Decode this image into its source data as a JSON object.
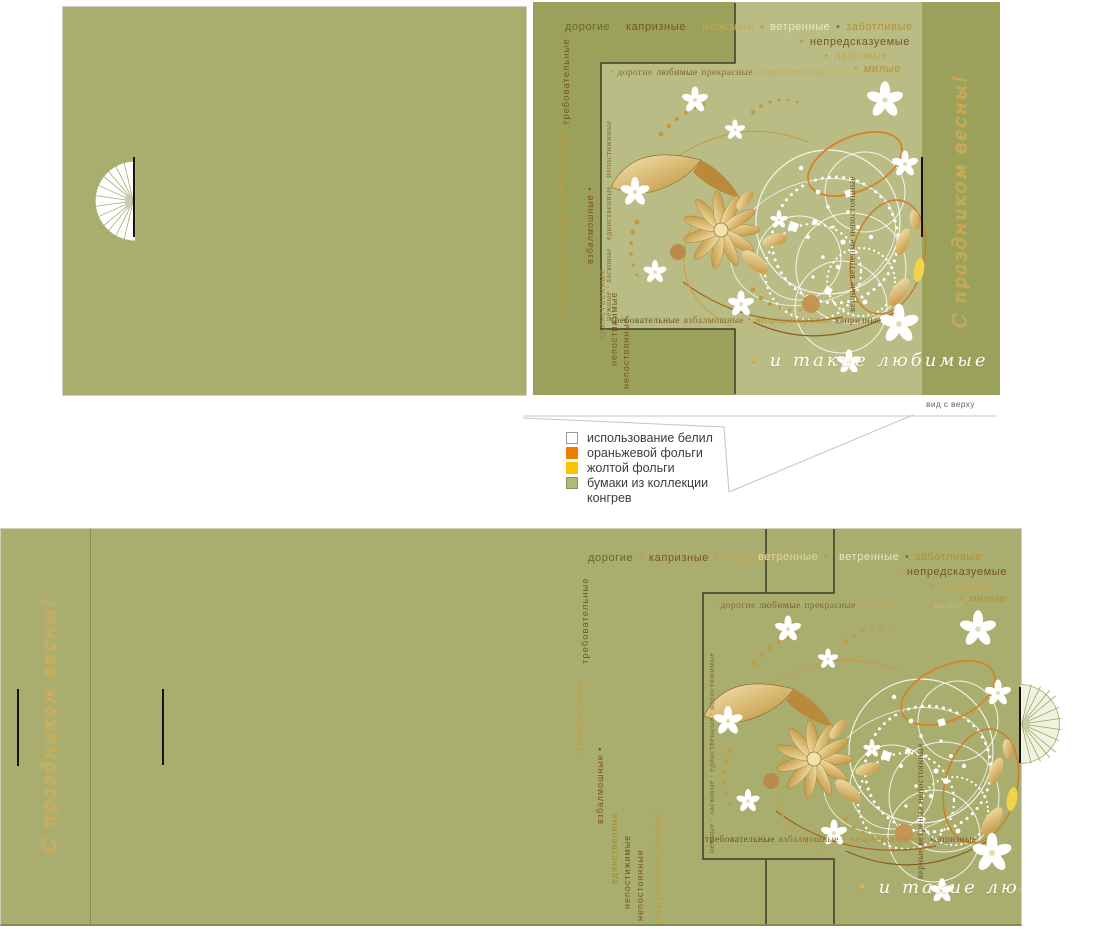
{
  "palette": {
    "olive": "#a9ae6e",
    "olive_dark": "#9ba15b",
    "panel_light": "#b9bd85",
    "gold": "#c59a3e",
    "script_gold": "#d2a03e",
    "outline": "#3c3c28",
    "orange_foil": "#ef7d00",
    "yellow_foil": "#fdc300"
  },
  "words": {
    "row1_top": [
      {
        "t": "дорогие",
        "c": "#6f6030"
      },
      {
        "t": "•",
        "c": "#c59a3e"
      },
      {
        "t": "капризные",
        "c": "#7b5322"
      },
      {
        "t": "•",
        "c": "#c59a3e"
      },
      {
        "t": "нежные",
        "c": "#c9a64c",
        "i": 1
      },
      {
        "t": "•",
        "c": "#c59a3e"
      },
      {
        "t": "ветренные",
        "c": "#ece6c6"
      },
      {
        "t": "•",
        "c": "#8a6a25"
      },
      {
        "t": "заботливые",
        "c": "#b68f35"
      }
    ],
    "row1a": [
      {
        "t": "дорогие",
        "c": "#6f6030"
      },
      {
        "t": "•",
        "c": "#c59a3e"
      },
      {
        "t": "капризные",
        "c": "#7b5322"
      },
      {
        "t": "•",
        "c": "#c59a3e"
      },
      {
        "t": "нежные",
        "c": "#c9a64c",
        "i": 1
      },
      {
        "t": "•",
        "c": "#c59a3e"
      }
    ],
    "row1b": [
      {
        "t": "ветренные",
        "c": "#e3d9a8"
      },
      {
        "t": "•",
        "c": "#c59a3e"
      }
    ],
    "row1c": [
      {
        "t": "ветренные",
        "c": "#ece6c6"
      },
      {
        "t": "•",
        "c": "#8a6a25"
      },
      {
        "t": "заботливые",
        "c": "#b68f35"
      }
    ],
    "row2": [
      {
        "t": "•",
        "c": "#c59a3e"
      },
      {
        "t": "непредсказуемые",
        "c": "#7b5322"
      }
    ],
    "row3": [
      {
        "t": "•",
        "c": "#c59a3e"
      },
      {
        "t": "ласковые",
        "c": "#c8a44a"
      }
    ],
    "row4": [
      {
        "t": "•",
        "c": "#c59a3e"
      },
      {
        "t": "милые",
        "c": "#b68f35"
      }
    ],
    "frame_top": [
      {
        "t": "•",
        "c": "#c59a3e"
      },
      {
        "t": "дорогие",
        "c": "#8a6a2a"
      },
      {
        "t": "любимые",
        "c": "#7b5f2a"
      },
      {
        "t": "прекрасные",
        "c": "#8a6a2a"
      },
      {
        "t": "очаровательные",
        "c": "#c0a75a"
      },
      {
        "t": "милые",
        "c": "#cdb76a"
      },
      {
        "t": "•",
        "c": "#c59a3e"
      }
    ],
    "frame_bottom": [
      {
        "t": "требовательные",
        "c": "#6b5324"
      },
      {
        "t": "взбалмошные",
        "c": "#8a6a2a"
      },
      {
        "t": "•",
        "c": "#c59a3e"
      },
      {
        "t": "непредсказуемые",
        "c": "#b68f35"
      },
      {
        "t": "капризные",
        "c": "#7b5322"
      }
    ],
    "frame_left": "нежные · ласковые · единственные · непостижимые",
    "frame_right": "верные ветреные непостоянные",
    "col_demanding": "требовательные",
    "col_beautiful": "прекрасные",
    "col_cluster": [
      "взбалмошные •",
      "единственные",
      "непостижимые",
      "непостоянные"
    ],
    "col_charming": "очаровательные"
  },
  "scripts": {
    "spring_greeting": "С праздником весны!",
    "so_loved": "и такие любимые",
    "bullet": "•"
  },
  "legend": {
    "view_label": "вид с верху",
    "items": [
      {
        "label": "использование белил",
        "color": "#ffffff",
        "border": "#9a9a9a"
      },
      {
        "label": "ораньжевой фольги",
        "color": "#ef7d00",
        "border": "#ef7d00"
      },
      {
        "label": "жолтой фольги",
        "color": "#fdc300",
        "border": "#fdc300"
      },
      {
        "label": "бумаки из коллекции конгрев",
        "color": "#b2b87f",
        "border": "#8a8f5a"
      }
    ]
  }
}
